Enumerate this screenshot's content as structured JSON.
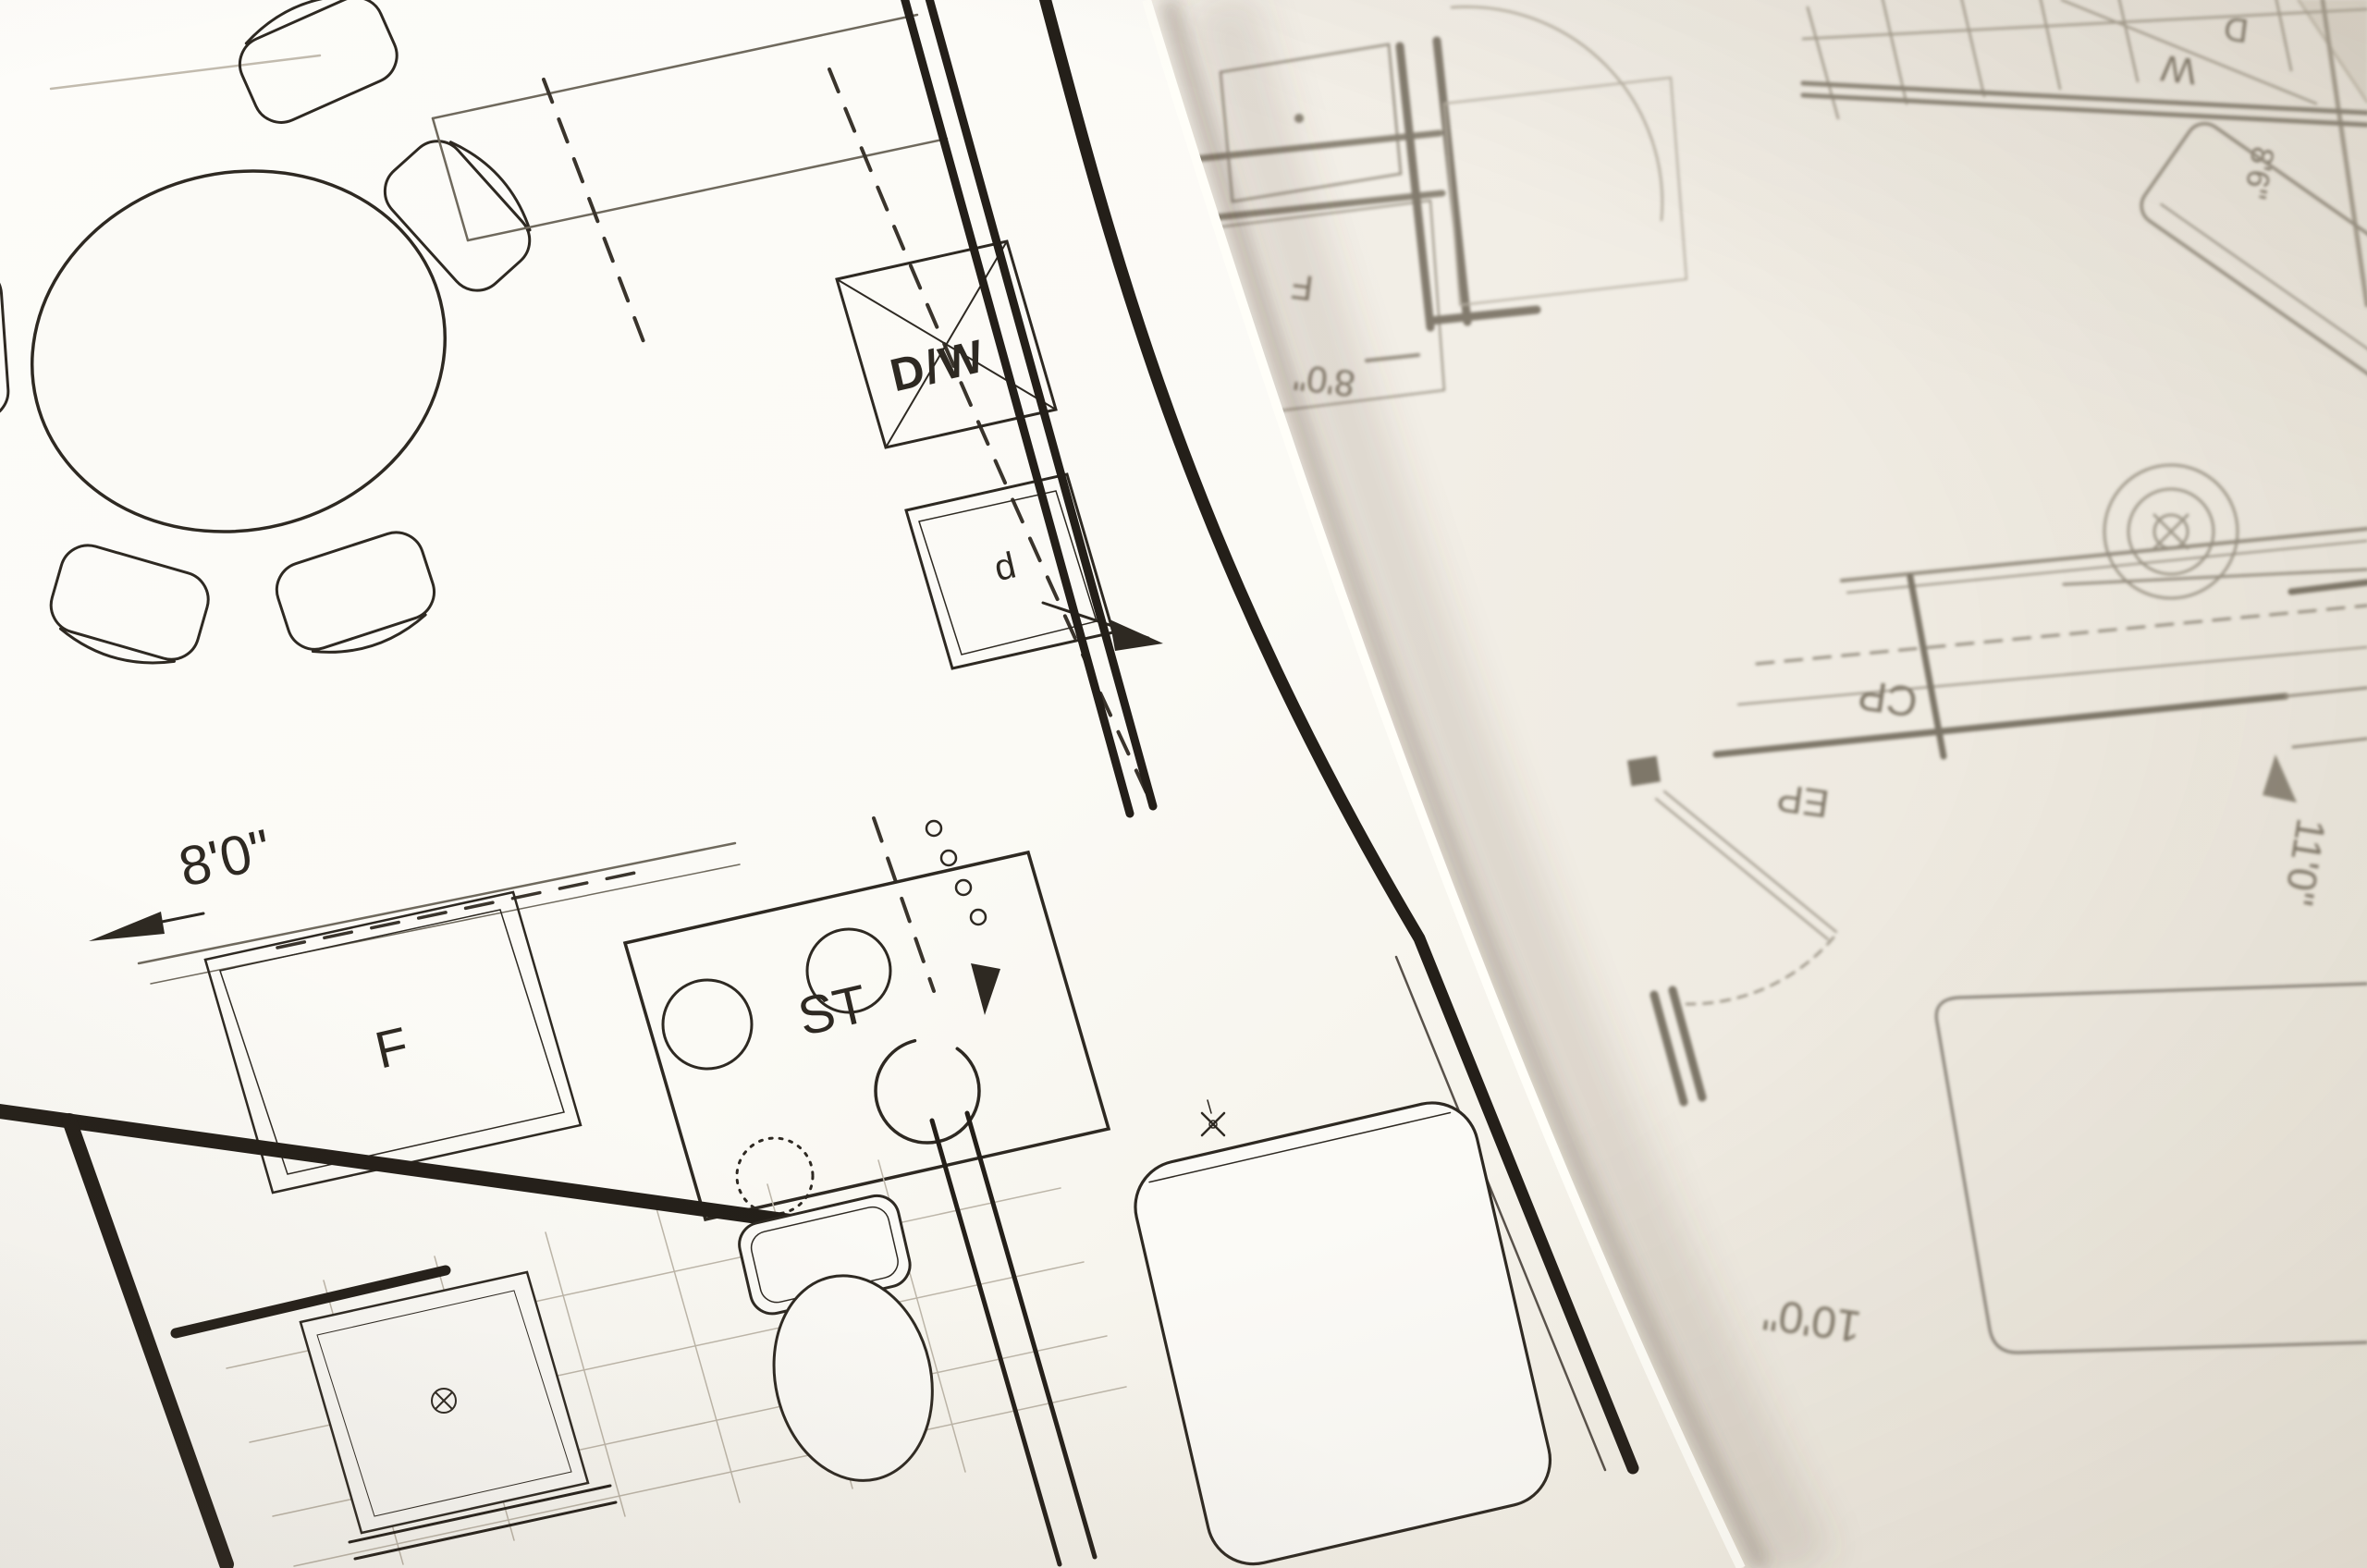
{
  "scene": {
    "kind": "photograph of two overlapping architectural floor plan sheets"
  },
  "colors": {
    "ink_dark": "#2b2620",
    "ink_mid": "#58514494",
    "pencil_gray": "#968f81",
    "paper_top": "#fcfbf7",
    "paper_bottom": "#f2eee6",
    "edge_shadow": "rgba(92,78,62,0.32)"
  },
  "top_sheet": {
    "labels": {
      "dishwasher": "D/W",
      "stove": "ST",
      "fridge": "F",
      "cabinet": "d",
      "dim_width": "8'0\""
    }
  },
  "bottom_sheet": {
    "labels": {
      "closet": "CP",
      "panel": "EP",
      "washer": "W",
      "dryer": "D",
      "fridge": "F"
    },
    "dims": {
      "fridge_width": "8'0\"",
      "closet_depth": "11'0\"",
      "room_width": "10'0\"",
      "laundry_width": "8'6\""
    }
  }
}
